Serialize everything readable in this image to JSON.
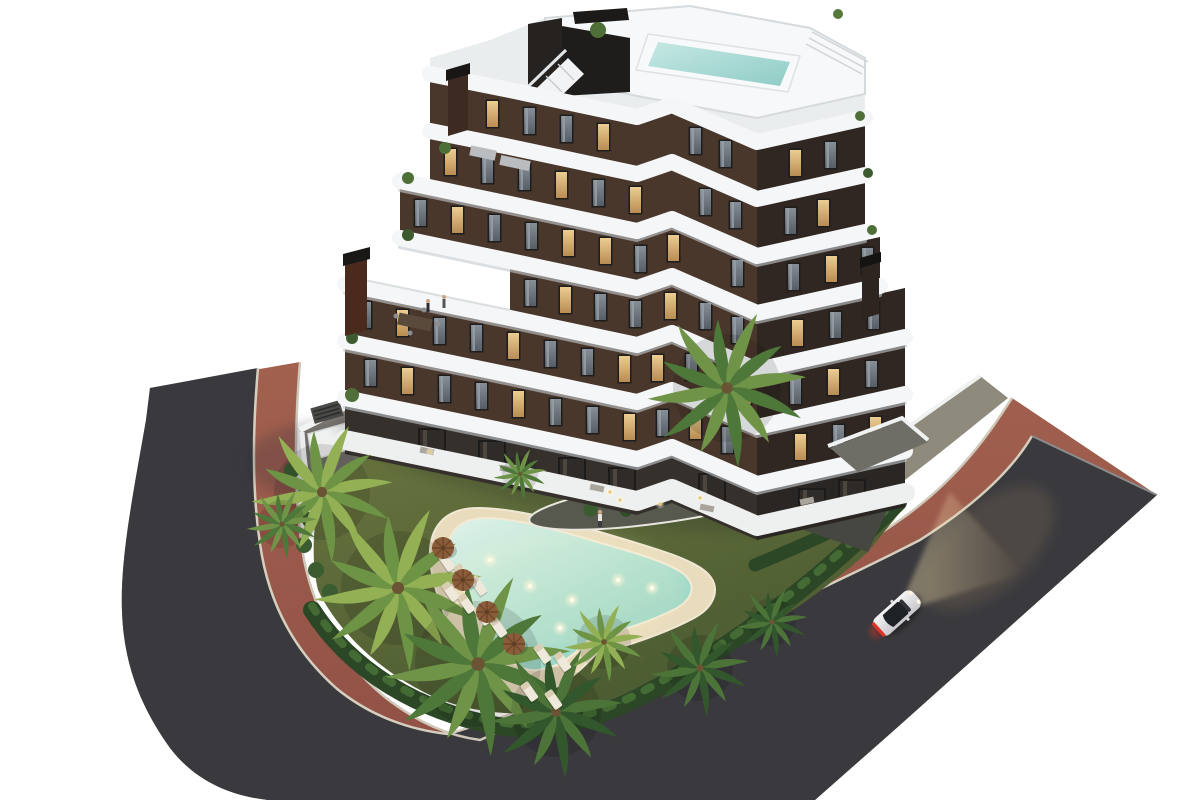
{
  "meta": {
    "scene_type": "3d-architectural-render",
    "description": "Aerial dusk rendering of a modern apartment building with white curved balcony bands, rooftop pool, landscaped garden, kidney-shaped swimming pool, palm trees, curving road with red sidewalk and one white car"
  },
  "palette": {
    "background": "#ffffff",
    "asphalt": "#3a3a3e",
    "sidewalk_red": "#9c584c",
    "curb": "#d2cbba",
    "concrete": "#87827a",
    "gray_strip": "#8e8b7c",
    "lawn_light": "#6a753f",
    "lawn_dark": "#4a5a31",
    "hedge": "#2c4726",
    "hedge_highlight": "#4f7a3a",
    "sand": "#e9dcbd",
    "pool_shallow": "#dff2e8",
    "pool_deep": "#8fd0bf",
    "rooftop_pool": "#9fd4cd",
    "band_white": "#f4f6f7",
    "band_shadow": "#c6cbd0",
    "facade_left": "#4a372c",
    "facade_right": "#302722",
    "glass_dark": "#35302c",
    "window_lit": "#e3bd83",
    "window_dark": "#79818a",
    "palm_bright_a": "#93b054",
    "palm_bright_b": "#6d9345",
    "palm_mid_a": "#6f9448",
    "palm_mid_b": "#4d7839",
    "palm_dark_a": "#4c7439",
    "palm_dark_b": "#33572c",
    "umbrella": "#8a5c39",
    "lounger": "#efe9dc",
    "car_body": "#eeeef1",
    "taillight": "#d8342a",
    "headlight_glow": "#f2dfae",
    "terrace_dark": "#474741",
    "chimney": "#3d2b22"
  },
  "scene": {
    "car": {
      "x": 897,
      "y": 613,
      "angle": -42
    },
    "windows": [
      [
        450,
        93,
        0
      ],
      [
        487,
        101,
        1
      ],
      [
        524,
        108,
        0
      ],
      [
        561,
        116,
        0
      ],
      [
        598,
        124,
        1
      ],
      [
        690,
        128,
        0
      ],
      [
        720,
        141,
        0
      ],
      [
        790,
        150,
        1
      ],
      [
        825,
        142,
        0
      ],
      [
        445,
        149,
        1
      ],
      [
        482,
        157,
        0
      ],
      [
        519,
        164,
        0
      ],
      [
        556,
        172,
        1
      ],
      [
        593,
        180,
        0
      ],
      [
        630,
        187,
        1
      ],
      [
        700,
        189,
        0
      ],
      [
        730,
        202,
        0
      ],
      [
        785,
        208,
        0
      ],
      [
        818,
        200,
        1
      ],
      [
        415,
        200,
        0
      ],
      [
        452,
        207,
        1
      ],
      [
        489,
        215,
        0
      ],
      [
        526,
        223,
        0
      ],
      [
        563,
        230,
        1
      ],
      [
        600,
        238,
        1
      ],
      [
        635,
        246,
        0
      ],
      [
        668,
        235,
        1
      ],
      [
        732,
        260,
        0
      ],
      [
        788,
        264,
        0
      ],
      [
        826,
        256,
        1
      ],
      [
        862,
        248,
        0
      ],
      [
        525,
        280,
        0
      ],
      [
        560,
        287,
        1
      ],
      [
        595,
        294,
        0
      ],
      [
        630,
        301,
        0
      ],
      [
        665,
        293,
        1
      ],
      [
        700,
        303,
        0
      ],
      [
        732,
        317,
        0
      ],
      [
        792,
        320,
        1
      ],
      [
        830,
        312,
        0
      ],
      [
        868,
        303,
        0
      ],
      [
        360,
        302,
        0
      ],
      [
        397,
        310,
        1
      ],
      [
        434,
        318,
        0
      ],
      [
        471,
        325,
        0
      ],
      [
        508,
        333,
        1
      ],
      [
        545,
        341,
        0
      ],
      [
        582,
        349,
        0
      ],
      [
        619,
        356,
        1
      ],
      [
        652,
        355,
        1
      ],
      [
        686,
        354,
        0
      ],
      [
        718,
        368,
        0
      ],
      [
        740,
        378,
        1
      ],
      [
        790,
        378,
        0
      ],
      [
        828,
        369,
        1
      ],
      [
        866,
        361,
        0
      ],
      [
        365,
        360,
        0
      ],
      [
        402,
        368,
        1
      ],
      [
        439,
        376,
        0
      ],
      [
        476,
        383,
        0
      ],
      [
        513,
        391,
        1
      ],
      [
        550,
        399,
        0
      ],
      [
        587,
        407,
        0
      ],
      [
        624,
        414,
        1
      ],
      [
        657,
        410,
        0
      ],
      [
        690,
        413,
        1
      ],
      [
        722,
        427,
        0
      ],
      [
        795,
        434,
        1
      ],
      [
        833,
        425,
        0
      ],
      [
        870,
        417,
        1
      ]
    ],
    "doors": [
      [
        420,
        430
      ],
      [
        480,
        442
      ],
      [
        560,
        459
      ],
      [
        610,
        469
      ],
      [
        700,
        475
      ],
      [
        800,
        490
      ],
      [
        840,
        481
      ]
    ],
    "palms": [
      {
        "x": 322,
        "y": 492,
        "s": 1.6,
        "v": "bright"
      },
      {
        "x": 398,
        "y": 588,
        "s": 1.9,
        "v": "bright"
      },
      {
        "x": 478,
        "y": 664,
        "s": 2.1,
        "v": "mid"
      },
      {
        "x": 556,
        "y": 712,
        "s": 1.5,
        "v": "dark"
      },
      {
        "x": 727,
        "y": 388,
        "s": 1.8,
        "v": "mid"
      },
      {
        "x": 604,
        "y": 642,
        "s": 0.9,
        "v": "bright"
      },
      {
        "x": 700,
        "y": 668,
        "s": 1.1,
        "v": "dark"
      },
      {
        "x": 772,
        "y": 622,
        "s": 0.8,
        "v": "dark"
      },
      {
        "x": 520,
        "y": 474,
        "s": 0.6,
        "v": "mid"
      },
      {
        "x": 282,
        "y": 524,
        "s": 0.8,
        "v": "mid"
      }
    ],
    "loungers": [
      [
        437,
        556
      ],
      [
        453,
        568
      ],
      [
        469,
        580
      ],
      [
        441,
        586
      ],
      [
        457,
        598
      ],
      [
        473,
        610
      ],
      [
        489,
        622
      ],
      [
        533,
        648
      ],
      [
        553,
        656
      ],
      [
        520,
        686
      ],
      [
        544,
        694
      ]
    ],
    "umbrellas": [
      [
        443,
        548
      ],
      [
        463,
        580
      ],
      [
        487,
        612
      ],
      [
        514,
        644
      ]
    ],
    "pool_lights": [
      [
        490,
        560
      ],
      [
        530,
        586
      ],
      [
        572,
        600
      ],
      [
        618,
        580
      ],
      [
        652,
        588
      ],
      [
        560,
        628
      ]
    ],
    "garden_lights": [
      [
        620,
        500
      ],
      [
        660,
        504
      ],
      [
        700,
        498
      ],
      [
        430,
        452
      ],
      [
        610,
        492
      ]
    ],
    "bushes": [
      [
        310,
        520
      ],
      [
        304,
        545
      ],
      [
        316,
        570
      ],
      [
        330,
        592
      ],
      [
        292,
        470
      ],
      [
        306,
        488
      ],
      [
        850,
        450
      ],
      [
        885,
        436
      ]
    ],
    "people": [
      {
        "x": 600,
        "y": 520,
        "kind": "pool"
      },
      {
        "x": 428,
        "y": 308,
        "kind": "terrace"
      },
      {
        "x": 444,
        "y": 304,
        "kind": "terrace"
      }
    ]
  }
}
